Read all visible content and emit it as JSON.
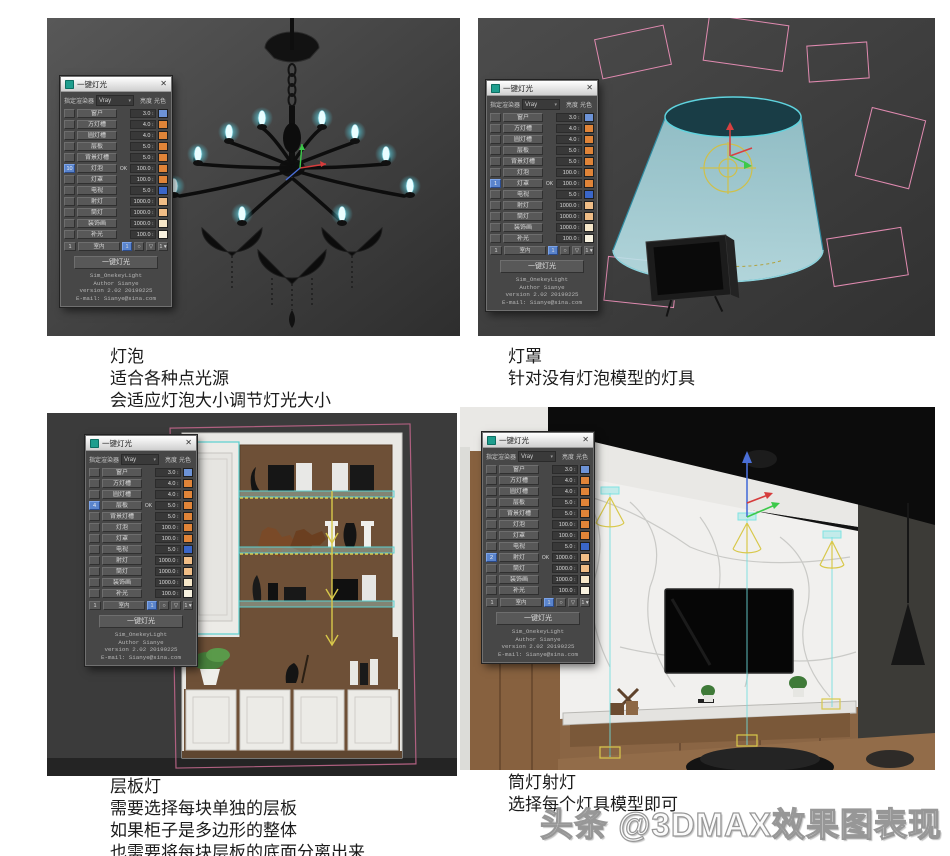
{
  "watermark": "头条 @3DMAX效果图表现",
  "panel": {
    "title": "一键灯光",
    "close_glyph": "✕",
    "renderer_label": "指定渲染器",
    "renderer_value": "Vray",
    "dropdown_arrow": "▾",
    "brightness_label": "亮度",
    "color_label": "光色",
    "ok_label": "OK",
    "spinner_glyph": "↕",
    "rows": [
      {
        "label": "窗户",
        "value": "3.0",
        "color": "#6d93d6"
      },
      {
        "label": "方灯槽",
        "value": "4.0",
        "color": "#e08438"
      },
      {
        "label": "圆灯槽",
        "value": "4.0",
        "color": "#e08438"
      },
      {
        "label": "层板",
        "value": "5.0",
        "color": "#e08438"
      },
      {
        "label": "背景灯槽",
        "value": "5.0",
        "color": "#e08438"
      },
      {
        "label": "灯泡",
        "value": "100.0",
        "color": "#e08438"
      },
      {
        "label": "灯罩",
        "value": "100.0",
        "color": "#e08438"
      },
      {
        "label": "电视",
        "value": "5.0",
        "color": "#3a66c8"
      },
      {
        "label": "射灯",
        "value": "1000.0",
        "color": "#f0bd86"
      },
      {
        "label": "筒灯",
        "value": "1000.0",
        "color": "#f0bd86"
      },
      {
        "label": "装饰画",
        "value": "1000.0",
        "color": "#f6e7c9"
      },
      {
        "label": "补光",
        "value": "100.0",
        "color": "#f8f2e0"
      }
    ],
    "bottom_controls": [
      "1",
      "室内",
      "1",
      "○",
      "▽",
      "1 ▾"
    ],
    "main_button": "一键灯光",
    "footer_lines": [
      "Sim_OnekeyLight",
      "Author Sianye",
      "version 2.02 20190225",
      "E-mail: Sianye@sina.com"
    ]
  },
  "viewports": [
    {
      "id": "bulb",
      "active_row": 5,
      "active_count": "10",
      "caption_title": "灯泡",
      "caption_lines": [
        "适合各种点光源",
        "会适应灯泡大小调节灯光大小"
      ]
    },
    {
      "id": "lampshade",
      "active_row": 6,
      "active_count": "1",
      "caption_title": "灯罩",
      "caption_lines": [
        "针对没有灯泡模型的灯具"
      ]
    },
    {
      "id": "shelf",
      "active_row": 3,
      "active_count": "4",
      "caption_title": "层板灯",
      "caption_lines": [
        "需要选择每块单独的层板",
        "如果柜子是多边形的整体",
        "也需要将每块层板的底面分离出来"
      ]
    },
    {
      "id": "downlight",
      "active_row": 8,
      "active_count": "2",
      "caption_title": "筒灯射灯",
      "caption_lines": [
        "选择每个灯具模型即可"
      ]
    }
  ]
}
